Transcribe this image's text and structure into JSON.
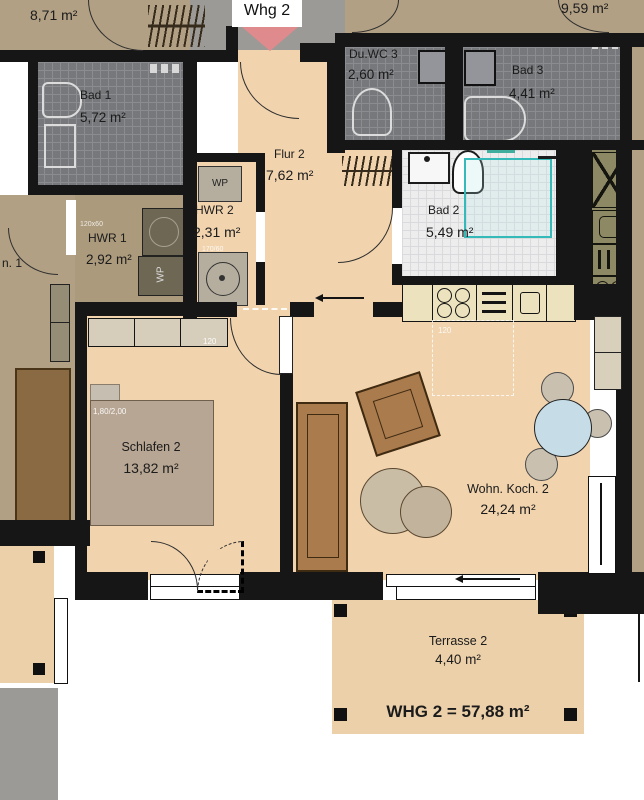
{
  "plan": {
    "entrance": {
      "label": "Whg 2"
    },
    "summary": {
      "total": "WHG 2 = 57,88 m²"
    },
    "rooms": {
      "flur2": {
        "name": "Flur 2",
        "area": "7,62 m²"
      },
      "hwr2": {
        "name": "HWR 2",
        "area": "2,31 m²"
      },
      "bad2": {
        "name": "Bad 2",
        "area": "5,49 m²"
      },
      "schlafen2": {
        "name": "Schlafen 2",
        "area": "13,82 m²"
      },
      "wohnkoch2": {
        "name": "Wohn. Koch. 2",
        "area": "24,24 m²"
      },
      "terrasse2": {
        "name": "Terrasse 2",
        "area": "4,40 m²"
      }
    },
    "neighbors": {
      "room871": {
        "area": "8,71 m²"
      },
      "bad1": {
        "name": "Bad 1",
        "area": "5,72 m²"
      },
      "hwr1": {
        "name": "HWR 1",
        "area": "2,92 m²"
      },
      "partial1": {
        "name": "n. 1"
      },
      "duwc3": {
        "name": "Du.WC 3",
        "area": "2,60 m²"
      },
      "bad3": {
        "name": "Bad 3",
        "area": "4,41 m²"
      },
      "room959": {
        "area": "9,59 m²"
      }
    },
    "annotations": {
      "bed_size": "1,80/2,00",
      "schlafen_door_width": "120",
      "living_door_width": "120",
      "hwr1_unit_size": "120x60",
      "hwr2_unit_size": "170/60",
      "wp1": "WP",
      "wp2": "WP"
    },
    "colors": {
      "wall": "#161616",
      "apartment_floor": "#f1d3ae",
      "neighbor_floor": "#b1a084",
      "corridor": "#9b9a97",
      "dark_tile": "#76787b",
      "light_tile": "#ededee",
      "terrace": "#ecd0a9",
      "accent_red": "#df8a8c",
      "accent_teal": "#3fae9e",
      "wood": "#aa7b4d",
      "table_blue": "#c6dde8"
    }
  }
}
